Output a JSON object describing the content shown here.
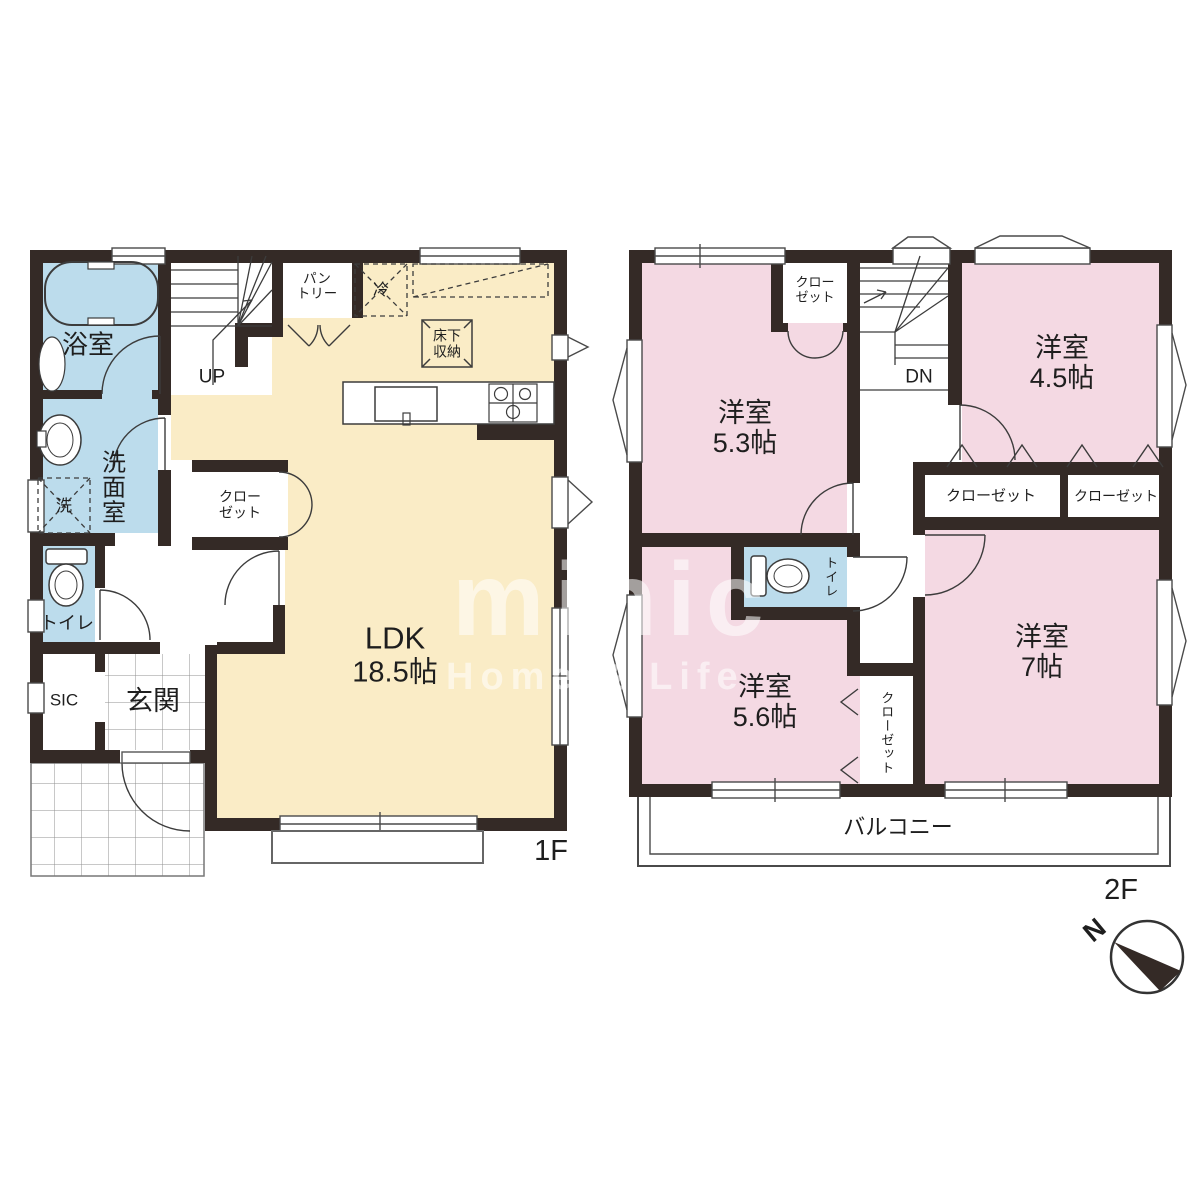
{
  "floor1": {
    "name": "1F",
    "bath": "浴室",
    "washroom": "洗面室",
    "laundry": "洗",
    "toilet": "トイレ",
    "shoe_closet": "SIC",
    "entrance": "玄関",
    "ldk": "LDK",
    "ldk_size": "18.5帖",
    "pantry_line1": "パン",
    "pantry_line2": "トリー",
    "fridge": "冷",
    "underfloor_line1": "床下",
    "underfloor_line2": "収納",
    "closet_line1": "クロー",
    "closet_line2": "ゼット",
    "stairs": "UP"
  },
  "floor2": {
    "name": "2F",
    "room_a": "洋室",
    "room_a_size": "5.3帖",
    "room_b": "洋室",
    "room_b_size": "4.5帖",
    "room_c": "洋室",
    "room_c_size": "7帖",
    "room_d": "洋室",
    "room_d_size": "5.6帖",
    "closet_top_line1": "クロー",
    "closet_top_line2": "ゼット",
    "closet_left": "クローゼット",
    "closet_right": "クローゼット",
    "closet_side": "クローゼット",
    "toilet": "トイレ",
    "stairs": "DN",
    "balcony": "バルコニー"
  },
  "watermark": {
    "brand": "minic",
    "tagline": "Home & Life"
  },
  "compass": {
    "north": "N"
  },
  "colors": {
    "wall": "#342a26",
    "ldk_fill": "#faecc6",
    "bedroom_fill": "#f4d9e3",
    "wet_fill": "#bcdcec"
  }
}
